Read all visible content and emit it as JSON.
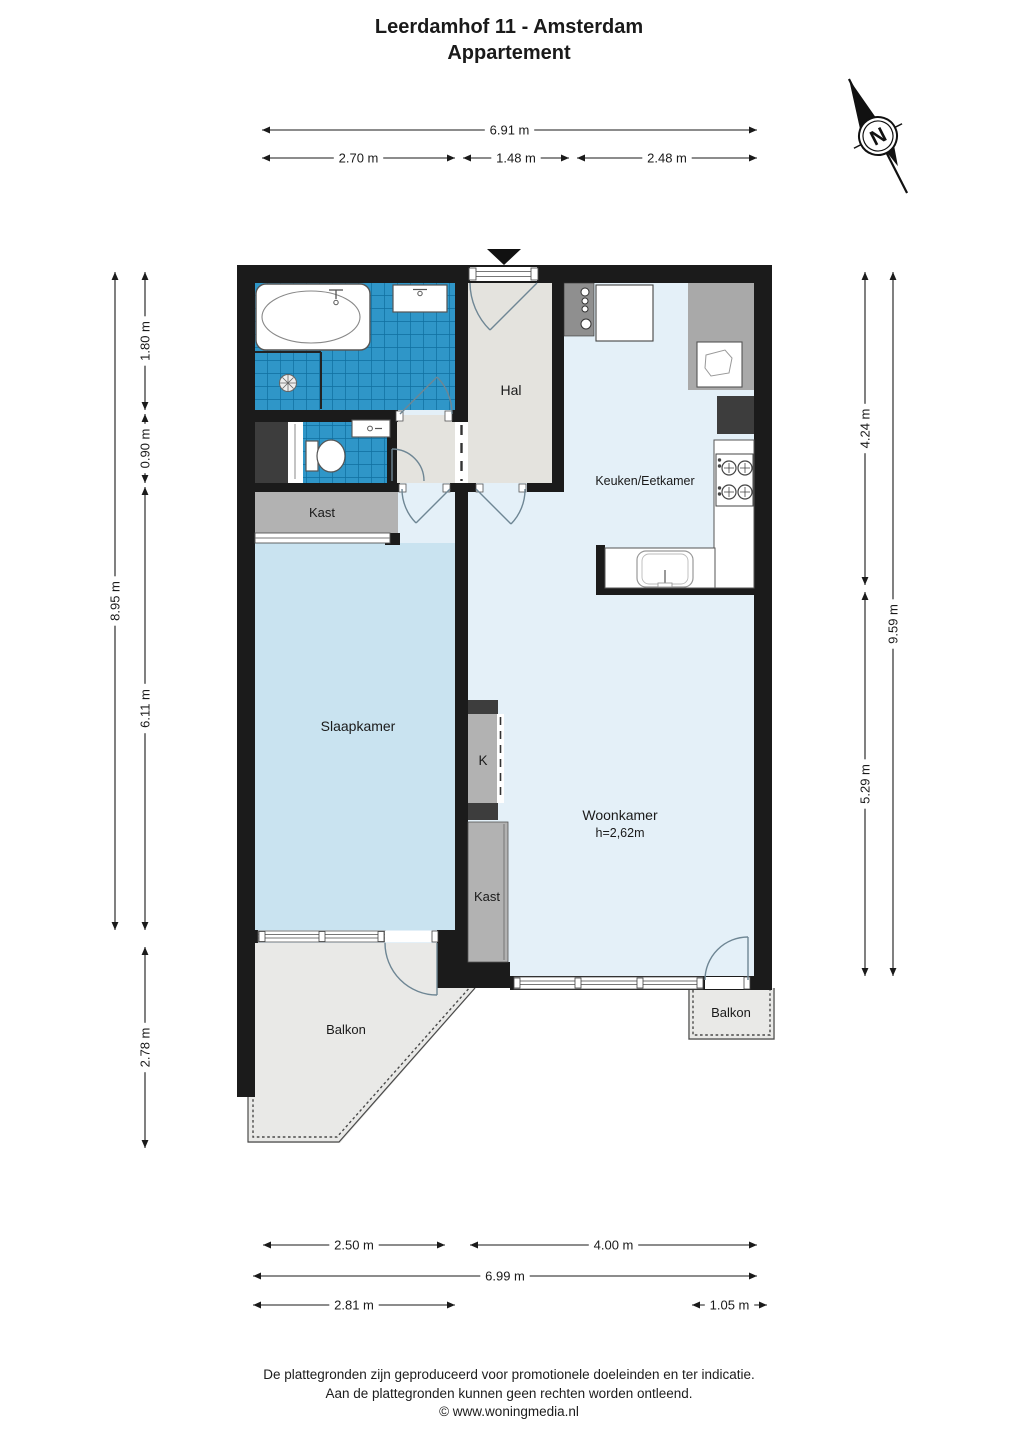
{
  "title": {
    "line1": "Leerdamhof 11 - Amsterdam",
    "line2": "Appartement"
  },
  "compass": {
    "label": "N"
  },
  "plan": {
    "room_labels": [
      {
        "id": "hal",
        "label": "Hal",
        "x": 511,
        "y": 395,
        "size": 14
      },
      {
        "id": "keuken",
        "label": "Keuken/Eetkamer",
        "x": 645,
        "y": 485,
        "size": 12.5
      },
      {
        "id": "kast-top",
        "label": "Kast",
        "x": 322,
        "y": 517,
        "size": 13
      },
      {
        "id": "slaapkamer",
        "label": "Slaapkamer",
        "x": 358,
        "y": 731,
        "size": 14
      },
      {
        "id": "k-closet",
        "label": "K",
        "x": 483,
        "y": 765,
        "size": 13.5
      },
      {
        "id": "woonkamer",
        "label": "Woonkamer",
        "x": 620,
        "y": 820,
        "size": 14
      },
      {
        "id": "woonkamer-h",
        "label": "h=2,62m",
        "x": 620,
        "y": 837,
        "size": 12.5
      },
      {
        "id": "kast-mid",
        "label": "Kast",
        "x": 487,
        "y": 901,
        "size": 13
      },
      {
        "id": "balkon-left",
        "label": "Balkon",
        "x": 346,
        "y": 1034,
        "size": 13
      },
      {
        "id": "balkon-right",
        "label": "Balkon",
        "x": 731,
        "y": 1017,
        "size": 13
      }
    ],
    "dimensions": {
      "top": [
        {
          "label": "6.91 m",
          "y": 130,
          "x1": 262,
          "x2": 757
        },
        {
          "label": "2.70 m",
          "y": 158,
          "x1": 262,
          "x2": 455
        },
        {
          "label": "1.48 m",
          "y": 158,
          "x1": 463,
          "x2": 569
        },
        {
          "label": "2.48 m",
          "y": 158,
          "x1": 577,
          "x2": 757
        }
      ],
      "bottom": [
        {
          "label": "2.50 m",
          "y": 1245,
          "x1": 263,
          "x2": 445
        },
        {
          "label": "4.00 m",
          "y": 1245,
          "x1": 470,
          "x2": 757
        },
        {
          "label": "6.99 m",
          "y": 1276,
          "x1": 253,
          "x2": 757
        },
        {
          "label": "2.81 m",
          "y": 1305,
          "x1": 253,
          "x2": 455
        },
        {
          "label": "1.05 m",
          "y": 1305,
          "x1": 692,
          "x2": 767
        }
      ],
      "left": [
        {
          "label": "8.95 m",
          "x": 115,
          "y1": 272,
          "y2": 930
        },
        {
          "label": "1.80 m",
          "x": 145,
          "y1": 272,
          "y2": 410
        },
        {
          "label": "0.90 m",
          "x": 145,
          "y1": 414,
          "y2": 483
        },
        {
          "label": "6.11 m",
          "x": 145,
          "y1": 487,
          "y2": 930
        },
        {
          "label": "2.78 m",
          "x": 145,
          "y1": 947,
          "y2": 1148
        }
      ],
      "right": [
        {
          "label": "4.24 m",
          "x": 865,
          "y1": 272,
          "y2": 585
        },
        {
          "label": "5.29 m",
          "x": 865,
          "y1": 592,
          "y2": 976
        },
        {
          "label": "9.59 m",
          "x": 893,
          "y1": 272,
          "y2": 976
        }
      ]
    }
  },
  "footer": {
    "line1": "De plattegronden zijn geproduceerd voor promotionele doeleinden en ter indicatie.",
    "line2": "Aan de plattegronden kunnen geen rechten worden ontleend.",
    "line3": "© www.woningmedia.nl"
  },
  "colors": {
    "wall": "#1b1b1b",
    "tile": "#2f96c8",
    "tile_grid": "#0f6f9f",
    "bedroom": "#c9e3f0",
    "living": "#e4f0f8",
    "hall": "#e4e3de",
    "balcony": "#e9e9e7",
    "closet_gray": "#b2b2b2",
    "counter_gray": "#a9a9a9",
    "meter_gray": "#8f8f8f",
    "dark_unit": "#3d3d3d",
    "door_arc": "#6e8694",
    "fixture": "#555555",
    "dim_line": "#1a1a1a",
    "text": "#1a1a1a"
  }
}
